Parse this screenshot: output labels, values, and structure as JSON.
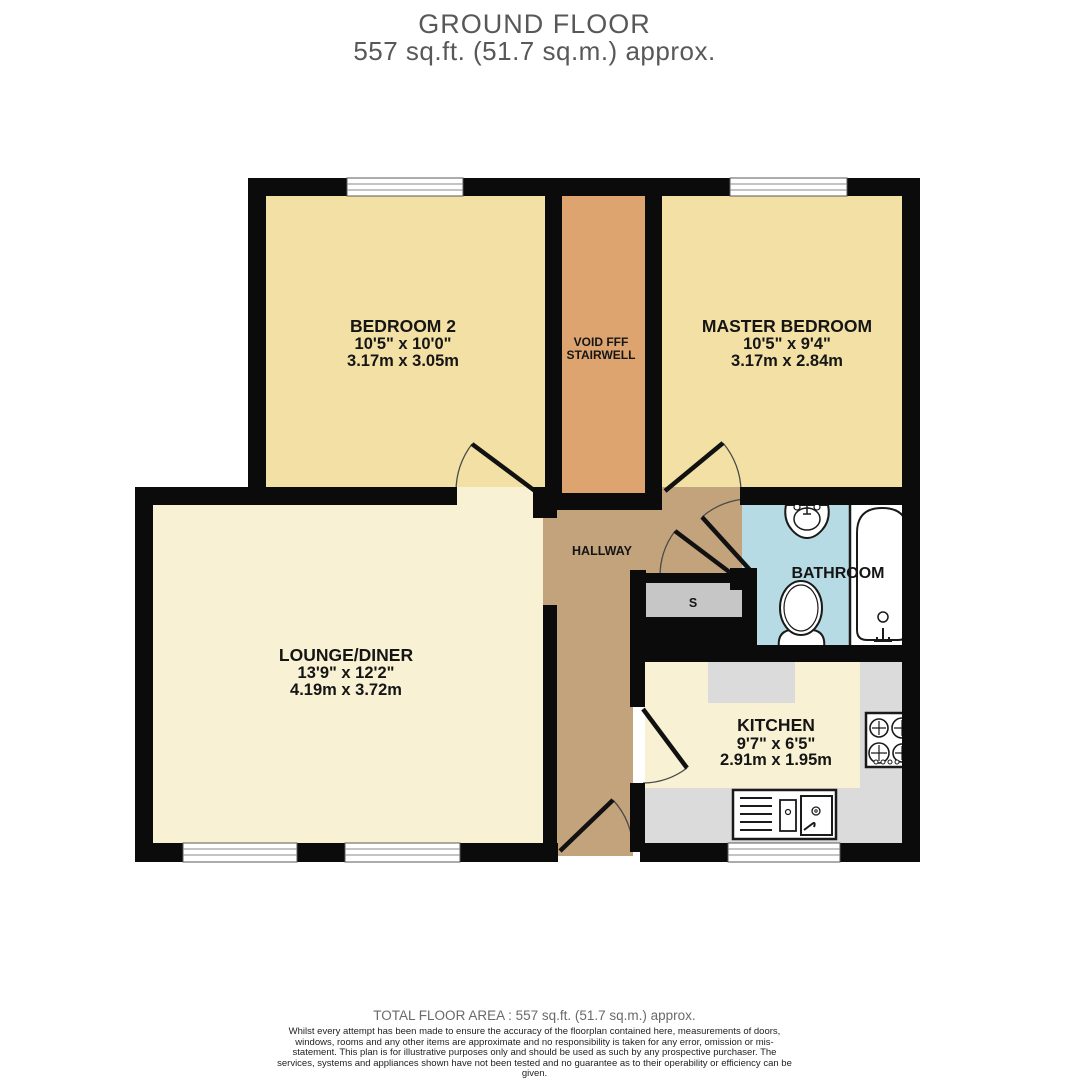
{
  "header": {
    "title": "GROUND FLOOR",
    "subtitle": "557 sq.ft. (51.7 sq.m.) approx."
  },
  "rooms": {
    "bedroom2": {
      "name": "BEDROOM 2",
      "imperial": "10'5\"  x 10'0\"",
      "metric": "3.17m  x 3.05m"
    },
    "master_bedroom": {
      "name": "MASTER BEDROOM",
      "imperial": "10'5\"  x 9'4\"",
      "metric": "3.17m  x 2.84m"
    },
    "lounge_diner": {
      "name": "LOUNGE/DINER",
      "imperial": "13'9\"  x 12'2\"",
      "metric": "4.19m  x 3.72m"
    },
    "kitchen": {
      "name": "KITCHEN",
      "imperial": "9'7\"  x 6'5\"",
      "metric": "2.91m  x 1.95m"
    },
    "stairwell": {
      "line1": "VOID FFF",
      "line2": "STAIRWELL"
    },
    "hallway": {
      "name": "HALLWAY"
    },
    "bathroom": {
      "name": "BATHROOM"
    },
    "store": {
      "label": "S"
    }
  },
  "footer": {
    "total_area": "TOTAL FLOOR AREA : 557 sq.ft. (51.7 sq.m.) approx.",
    "disclaimer": "Whilst every attempt has been made to ensure the accuracy of the floorplan contained here, measurements of doors, windows, rooms and any other items are approximate and no responsibility is taken for any error, omission or mis-statement. This plan is for illustrative purposes only and should be used as such by any prospective purchaser. The services, systems and appliances shown have not been tested and no guarantee as to their operability or efficiency can be given.",
    "credit": "Made with Metropix ©2025"
  },
  "colors": {
    "wall": "#0b0b0b",
    "bedroom_floor": "#f3e0a5",
    "lounge_floor": "#f8f1d4",
    "stairwell_floor": "#dda46f",
    "hallway_floor": "#c3a37c",
    "bathroom_floor": "#b7dbe4",
    "counter": "#dbdbdb",
    "storage": "#c6c6c6",
    "fixture_fill": "#ffffff",
    "fixture_stroke": "#1a1a1a"
  }
}
